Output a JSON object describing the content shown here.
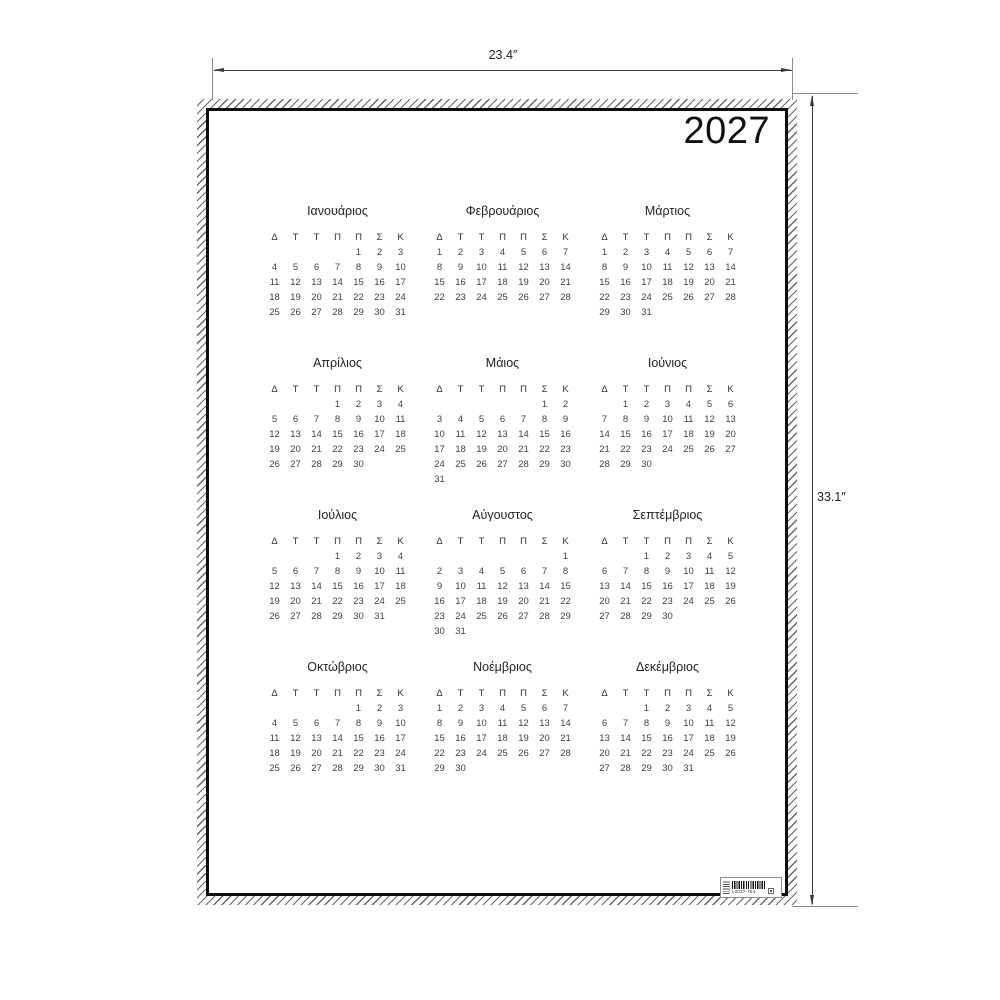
{
  "poster": {
    "year": "2027",
    "day_headers": [
      "Δ",
      "Τ",
      "Τ",
      "Π",
      "Π",
      "Σ",
      "Κ"
    ],
    "months": [
      {
        "name": "Ιανουάριος",
        "weeks": [
          [
            "",
            "",
            "",
            "",
            "1",
            "2",
            "3"
          ],
          [
            "4",
            "5",
            "6",
            "7",
            "8",
            "9",
            "10"
          ],
          [
            "11",
            "12",
            "13",
            "14",
            "15",
            "16",
            "17"
          ],
          [
            "18",
            "19",
            "20",
            "21",
            "22",
            "23",
            "24"
          ],
          [
            "25",
            "26",
            "27",
            "28",
            "29",
            "30",
            "31"
          ]
        ]
      },
      {
        "name": "Φεβρουάριος",
        "weeks": [
          [
            "1",
            "2",
            "3",
            "4",
            "5",
            "6",
            "7"
          ],
          [
            "8",
            "9",
            "10",
            "11",
            "12",
            "13",
            "14"
          ],
          [
            "15",
            "16",
            "17",
            "18",
            "19",
            "20",
            "21"
          ],
          [
            "22",
            "23",
            "24",
            "25",
            "26",
            "27",
            "28"
          ]
        ]
      },
      {
        "name": "Μάρτιος",
        "weeks": [
          [
            "1",
            "2",
            "3",
            "4",
            "5",
            "6",
            "7"
          ],
          [
            "8",
            "9",
            "10",
            "11",
            "12",
            "13",
            "14"
          ],
          [
            "15",
            "16",
            "17",
            "18",
            "19",
            "20",
            "21"
          ],
          [
            "22",
            "23",
            "24",
            "25",
            "26",
            "27",
            "28"
          ],
          [
            "29",
            "30",
            "31",
            "",
            "",
            "",
            ""
          ]
        ]
      },
      {
        "name": "Απρίλιος",
        "weeks": [
          [
            "",
            "",
            "",
            "1",
            "2",
            "3",
            "4"
          ],
          [
            "5",
            "6",
            "7",
            "8",
            "9",
            "10",
            "11"
          ],
          [
            "12",
            "13",
            "14",
            "15",
            "16",
            "17",
            "18"
          ],
          [
            "19",
            "20",
            "21",
            "22",
            "23",
            "24",
            "25"
          ],
          [
            "26",
            "27",
            "28",
            "29",
            "30",
            "",
            ""
          ]
        ]
      },
      {
        "name": "Μάιος",
        "weeks": [
          [
            "",
            "",
            "",
            "",
            "",
            "1",
            "2"
          ],
          [
            "3",
            "4",
            "5",
            "6",
            "7",
            "8",
            "9"
          ],
          [
            "10",
            "11",
            "12",
            "13",
            "14",
            "15",
            "16"
          ],
          [
            "17",
            "18",
            "19",
            "20",
            "21",
            "22",
            "23"
          ],
          [
            "24",
            "25",
            "26",
            "27",
            "28",
            "29",
            "30"
          ],
          [
            "31",
            "",
            "",
            "",
            "",
            "",
            ""
          ]
        ]
      },
      {
        "name": "Ιούνιος",
        "weeks": [
          [
            "",
            "1",
            "2",
            "3",
            "4",
            "5",
            "6"
          ],
          [
            "7",
            "8",
            "9",
            "10",
            "11",
            "12",
            "13"
          ],
          [
            "14",
            "15",
            "16",
            "17",
            "18",
            "19",
            "20"
          ],
          [
            "21",
            "22",
            "23",
            "24",
            "25",
            "26",
            "27"
          ],
          [
            "28",
            "29",
            "30",
            "",
            "",
            "",
            ""
          ]
        ]
      },
      {
        "name": "Ιούλιος",
        "weeks": [
          [
            "",
            "",
            "",
            "1",
            "2",
            "3",
            "4"
          ],
          [
            "5",
            "6",
            "7",
            "8",
            "9",
            "10",
            "11"
          ],
          [
            "12",
            "13",
            "14",
            "15",
            "16",
            "17",
            "18"
          ],
          [
            "19",
            "20",
            "21",
            "22",
            "23",
            "24",
            "25"
          ],
          [
            "26",
            "27",
            "28",
            "29",
            "30",
            "31",
            ""
          ]
        ]
      },
      {
        "name": "Αύγουστος",
        "weeks": [
          [
            "",
            "",
            "",
            "",
            "",
            "",
            "1"
          ],
          [
            "2",
            "3",
            "4",
            "5",
            "6",
            "7",
            "8"
          ],
          [
            "9",
            "10",
            "11",
            "12",
            "13",
            "14",
            "15"
          ],
          [
            "16",
            "17",
            "18",
            "19",
            "20",
            "21",
            "22"
          ],
          [
            "23",
            "24",
            "25",
            "26",
            "27",
            "28",
            "29"
          ],
          [
            "30",
            "31",
            "",
            "",
            "",
            "",
            ""
          ]
        ]
      },
      {
        "name": "Σεπτέμβριος",
        "weeks": [
          [
            "",
            "",
            "1",
            "2",
            "3",
            "4",
            "5"
          ],
          [
            "6",
            "7",
            "8",
            "9",
            "10",
            "11",
            "12"
          ],
          [
            "13",
            "14",
            "15",
            "16",
            "17",
            "18",
            "19"
          ],
          [
            "20",
            "21",
            "22",
            "23",
            "24",
            "25",
            "26"
          ],
          [
            "27",
            "28",
            "29",
            "30",
            "",
            "",
            ""
          ]
        ]
      },
      {
        "name": "Οκτώβριος",
        "weeks": [
          [
            "",
            "",
            "",
            "",
            "1",
            "2",
            "3"
          ],
          [
            "4",
            "5",
            "6",
            "7",
            "8",
            "9",
            "10"
          ],
          [
            "11",
            "12",
            "13",
            "14",
            "15",
            "16",
            "17"
          ],
          [
            "18",
            "19",
            "20",
            "21",
            "22",
            "23",
            "24"
          ],
          [
            "25",
            "26",
            "27",
            "28",
            "29",
            "30",
            "31"
          ]
        ]
      },
      {
        "name": "Νοέμβριος",
        "weeks": [
          [
            "1",
            "2",
            "3",
            "4",
            "5",
            "6",
            "7"
          ],
          [
            "8",
            "9",
            "10",
            "11",
            "12",
            "13",
            "14"
          ],
          [
            "15",
            "16",
            "17",
            "18",
            "19",
            "20",
            "21"
          ],
          [
            "22",
            "23",
            "24",
            "25",
            "26",
            "27",
            "28"
          ],
          [
            "29",
            "30",
            "",
            "",
            "",
            "",
            ""
          ]
        ]
      },
      {
        "name": "Δεκέμβριος",
        "weeks": [
          [
            "",
            "",
            "1",
            "2",
            "3",
            "4",
            "5"
          ],
          [
            "6",
            "7",
            "8",
            "9",
            "10",
            "11",
            "12"
          ],
          [
            "13",
            "14",
            "15",
            "16",
            "17",
            "18",
            "19"
          ],
          [
            "20",
            "21",
            "22",
            "23",
            "24",
            "25",
            "26"
          ],
          [
            "27",
            "28",
            "29",
            "30",
            "31",
            "",
            ""
          ]
        ]
      }
    ],
    "barcode_number": "L2027-754"
  },
  "dimensions": {
    "width_label": "23.4″",
    "height_label": "33.1″"
  },
  "colors": {
    "ink": "#1c1c1c",
    "date_ink": "#3f3f3f",
    "dimension_line": "#3a3a3a",
    "hatch": "#666666"
  }
}
